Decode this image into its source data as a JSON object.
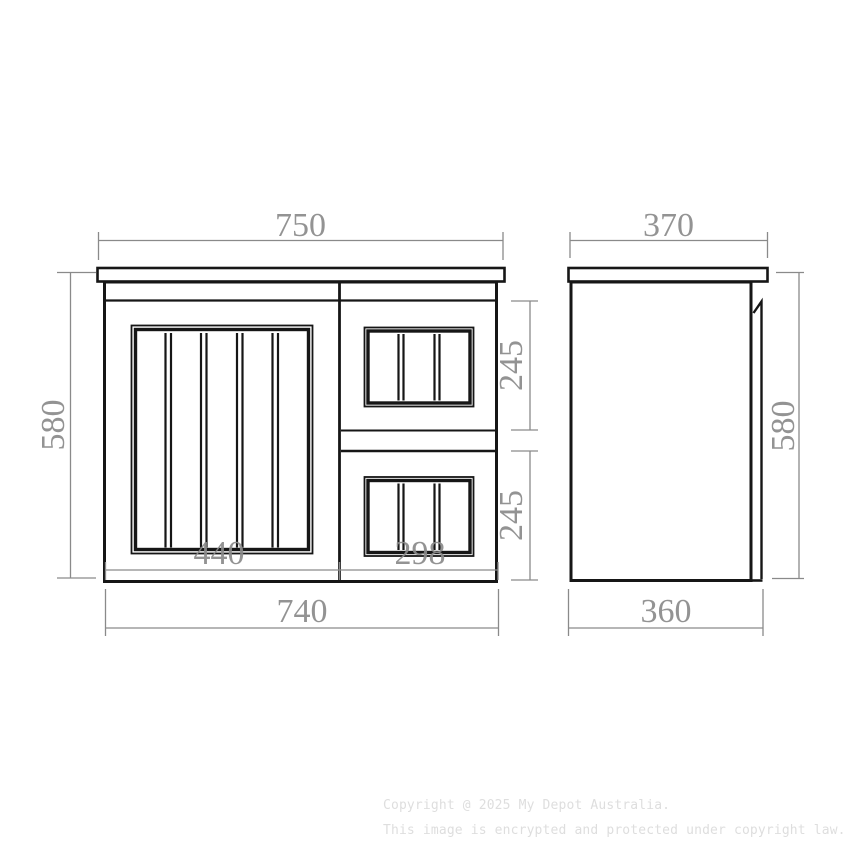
{
  "colors": {
    "background": "#ffffff",
    "drawing_line": "#161616",
    "dimension": "#8a8a8a",
    "watermark": "#dedede"
  },
  "front_view": {
    "dim_overall_width": "750",
    "dim_height": "580",
    "dim_door_width": "440",
    "dim_drawer_width": "298",
    "dim_cabinet_width": "740",
    "dim_top_drawer_height": "245",
    "dim_bottom_drawer_height": "245"
  },
  "side_view": {
    "dim_top_depth": "370",
    "dim_height": "580",
    "dim_bottom_depth": "360"
  },
  "watermark": {
    "line1": "Copyright @ 2025 My Depot Australia.",
    "line2": "This image is encrypted and protected under copyright law."
  }
}
